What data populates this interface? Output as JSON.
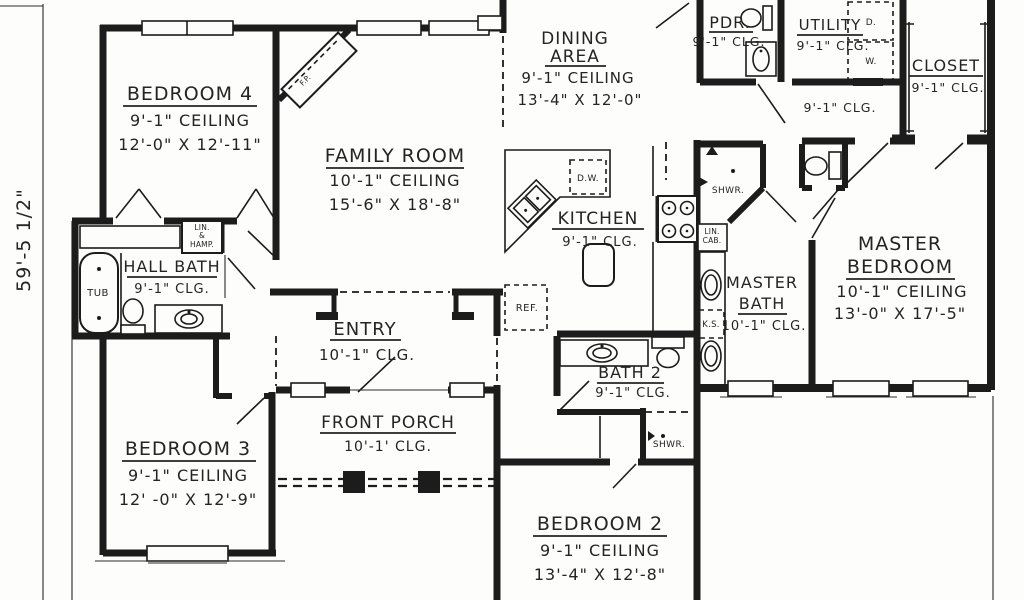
{
  "colors": {
    "ink": "#1c1c1c",
    "paper": "#fdfdfc"
  },
  "dimension_label": "59'-5 1/2\"",
  "rooms": {
    "bedroom4": {
      "name": "BEDROOM 4",
      "ceiling": "9'-1\" CEILING",
      "size": "12'-0\" X 12'-11\""
    },
    "family_room": {
      "name": "FAMILY ROOM",
      "ceiling": "10'-1\" CEILING",
      "size": "15'-6\" X 18'-8\""
    },
    "dining": {
      "name": "DINING",
      "name2": "AREA",
      "ceiling": "9'-1\" CEILING",
      "size": "13'-4\" X 12'-0\""
    },
    "pdr": {
      "name": "PDR.",
      "ceiling": "9'-1\" CLG."
    },
    "utility": {
      "name": "UTILITY",
      "ceiling": "9'-1\" CLG."
    },
    "closet": {
      "name": "CLOSET",
      "ceiling": "9'-1\" CLG."
    },
    "hall": {
      "ceiling": "9'-1\" CLG."
    },
    "kitchen": {
      "name": "KITCHEN",
      "ceiling": "9'-1\" CLG."
    },
    "hall_bath": {
      "name": "HALL BATH",
      "ceiling": "9'-1\" CLG."
    },
    "master_bath": {
      "name": "MASTER",
      "name2": "BATH",
      "ceiling": "10'-1\" CLG."
    },
    "master_bedroom": {
      "name": "MASTER",
      "name2": "BEDROOM",
      "ceiling": "10'-1\" CEILING",
      "size": "13'-0\" X 17'-5\""
    },
    "entry": {
      "name": "ENTRY",
      "ceiling": "10'-1\" CLG."
    },
    "bath2": {
      "name": "BATH 2",
      "ceiling": "9'-1\" CLG."
    },
    "bedroom3": {
      "name": "BEDROOM 3",
      "ceiling": "9'-1\" CEILING",
      "size": "12' -0\" X 12'-9\""
    },
    "front_porch": {
      "name": "FRONT PORCH",
      "ceiling": "10'-1' CLG."
    },
    "bedroom2": {
      "name": "BEDROOM 2",
      "ceiling": "9'-1\" CEILING",
      "size": "13'-4\" X 12'-8\""
    }
  },
  "fixtures": {
    "tub": "TUB",
    "linen1": "LIN.",
    "linen_amp": "&",
    "linen2": "HAMP.",
    "fireplace": "F.P.",
    "refrigerator": "REF.",
    "dishwasher": "D.W.",
    "shower_bath2": "SHWR.",
    "shower_master": "SHWR.",
    "lin_cab1": "LIN.",
    "lin_cab2": "CAB.",
    "knee_space": "K.S.",
    "dryer": "D.",
    "washer": "W."
  }
}
